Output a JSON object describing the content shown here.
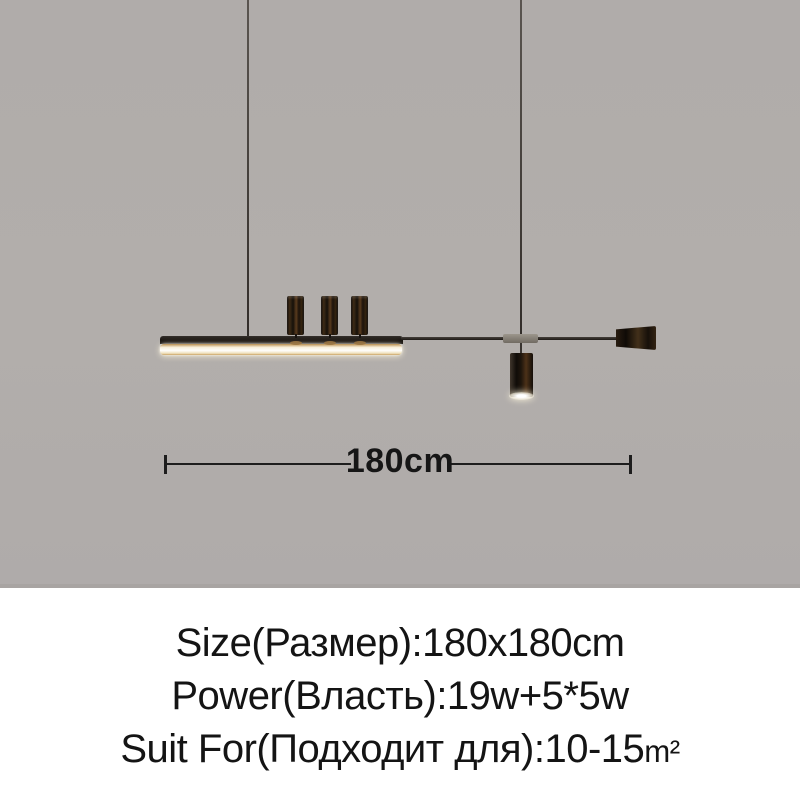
{
  "product_photo": {
    "background_color": "#b0acaa",
    "led_glow_color": "#fffefb",
    "wood_color": "#3e2b16",
    "dimension_label": "180cm"
  },
  "specs": {
    "size_line": "Size(Размер):180x180cm",
    "power_line": "Power(Власть):19w+5*5w",
    "suit_line_text": "Suit For(Подходит для):10-15",
    "suit_line_unit": "m²"
  }
}
